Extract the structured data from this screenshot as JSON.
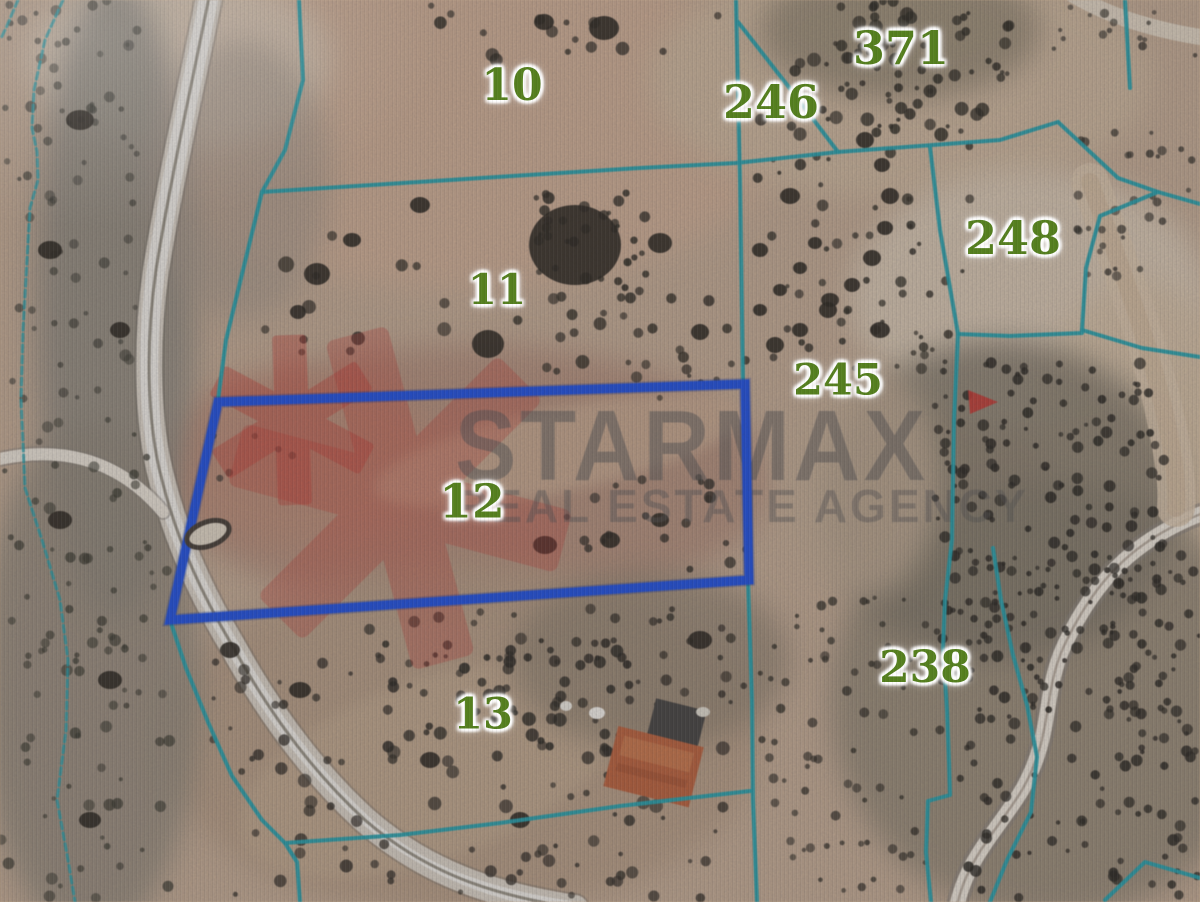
{
  "map": {
    "type": "cadastral-satellite-view",
    "parcel_labels": [
      {
        "id": "10",
        "x": 512,
        "y": 86,
        "size": 44
      },
      {
        "id": "371",
        "x": 901,
        "y": 48,
        "size": 46
      },
      {
        "id": "246",
        "x": 771,
        "y": 102,
        "size": 46
      },
      {
        "id": "248",
        "x": 1013,
        "y": 238,
        "size": 46
      },
      {
        "id": "11",
        "x": 497,
        "y": 290,
        "size": 42
      },
      {
        "id": "245",
        "x": 838,
        "y": 381,
        "size": 43
      },
      {
        "id": "12",
        "x": 472,
        "y": 502,
        "size": 47
      },
      {
        "id": "13",
        "x": 483,
        "y": 715,
        "size": 43
      },
      {
        "id": "238",
        "x": 925,
        "y": 668,
        "size": 44
      }
    ],
    "highlighted_parcel": {
      "id": "12",
      "outline_color": "#1d4fe0",
      "points": "218,402 745,384 749,580 170,620"
    },
    "boundary_color": "#1f9fa8",
    "label_color": "#557f1f",
    "watermark": {
      "brand": "STARMAX",
      "tagline": "REAL ESTATE AGENCY",
      "text_color": "#585652",
      "logo_color": "#c8352a"
    }
  }
}
